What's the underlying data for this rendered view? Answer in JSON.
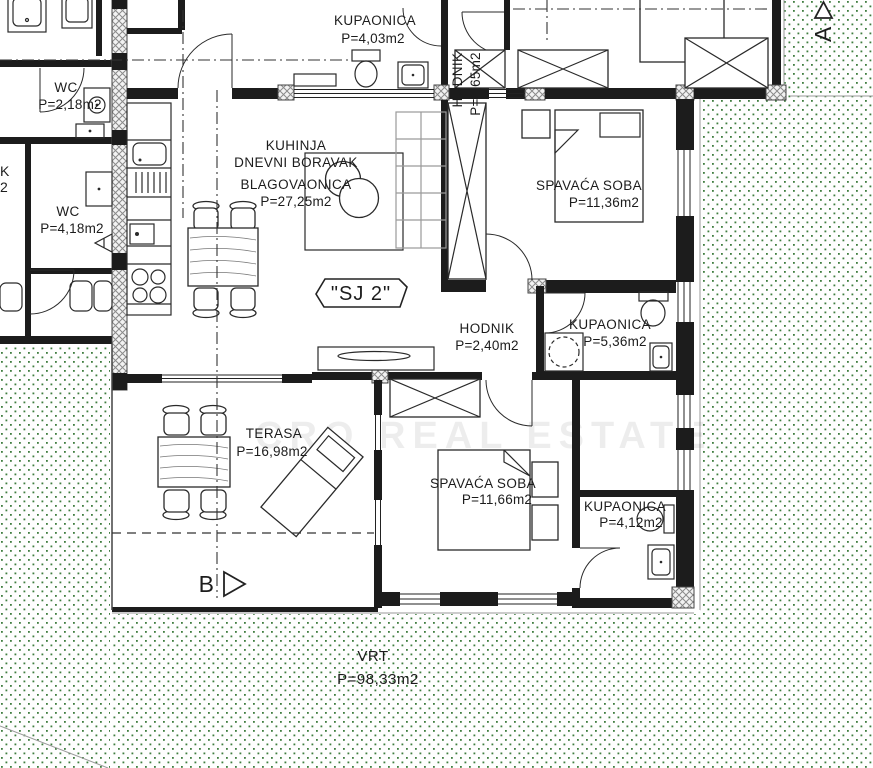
{
  "plan": {
    "unit_badge": "\"SJ 2\"",
    "rooms": [
      {
        "name": "KUPAONICA",
        "area": "P=4,03m2"
      },
      {
        "name": "HODNIK",
        "area": "P=1,65m2"
      },
      {
        "name": "WC",
        "area": "P=2,18m2"
      },
      {
        "name": "WC",
        "area": "P=4,18m2"
      },
      {
        "lines": [
          "KUHINJA",
          "DNEVNI BORAVAK",
          "BLAGOVAONICA"
        ],
        "area": "P=27,25m2"
      },
      {
        "name": "SPAVAĆA SOBA",
        "area": "P=11,36m2"
      },
      {
        "name": "HODNIK",
        "area": "P=2,40m2"
      },
      {
        "name": "KUPAONICA",
        "area": "P=5,36m2"
      },
      {
        "name": "TERASA",
        "area": "P=16,98m2"
      },
      {
        "name": "SPAVAĆA SOBA",
        "area": "P=11,66m2"
      },
      {
        "name": "KUPAONICA",
        "area": "P=4,12m2"
      },
      {
        "name": "VRT",
        "area": "P=98,33m2"
      }
    ],
    "markers": {
      "section_b": "B",
      "section_a": "A"
    },
    "partial_labels": {
      "left_edge_1": "K",
      "left_edge_2": "2"
    },
    "watermark": "CRO REAL ESTATE",
    "colors": {
      "wall": "#1c1c1c",
      "garden_dot": "#3f7d3f",
      "line": "#333333"
    }
  }
}
